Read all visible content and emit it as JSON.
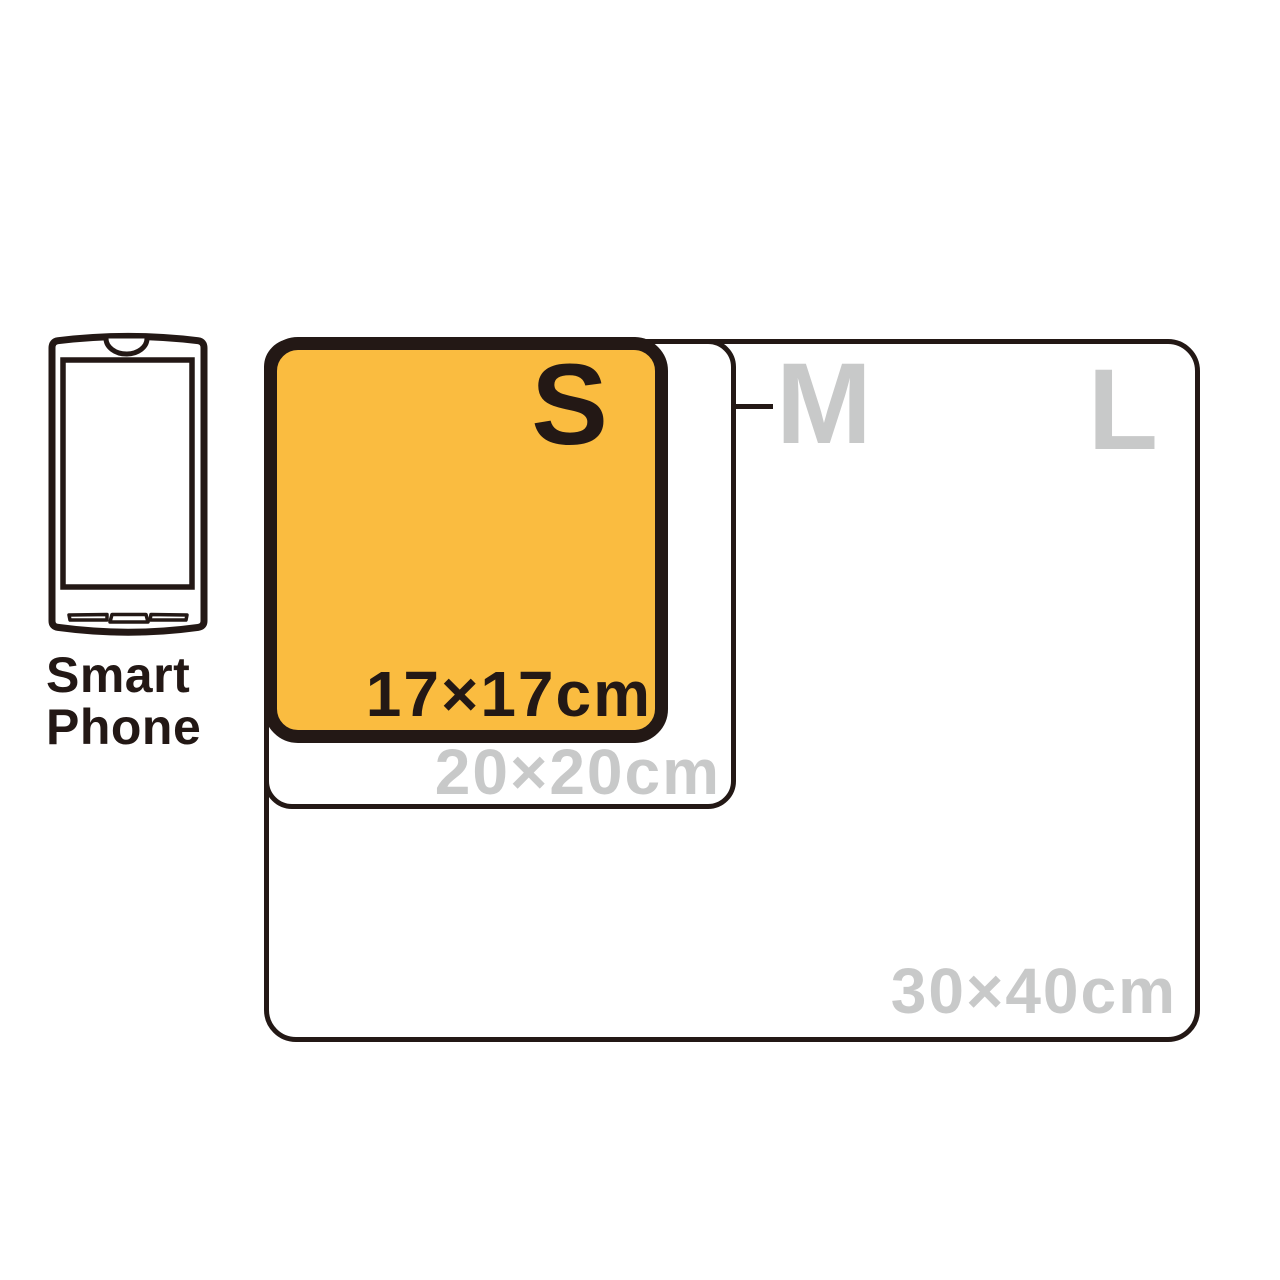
{
  "colors": {
    "background": "#ffffff",
    "outline_dark": "#231815",
    "size_s_fill": "#FABC40",
    "inactive_gray": "#C8C9C9"
  },
  "reference_object": {
    "type": "smartphone",
    "label_line1": "Smart",
    "label_line2": "Phone"
  },
  "sizes": [
    {
      "letter": "S",
      "dimension": "17×17cm",
      "highlighted": true
    },
    {
      "letter": "M",
      "dimension": "20×20cm",
      "highlighted": false
    },
    {
      "letter": "L",
      "dimension": "30×40cm",
      "highlighted": false
    }
  ]
}
